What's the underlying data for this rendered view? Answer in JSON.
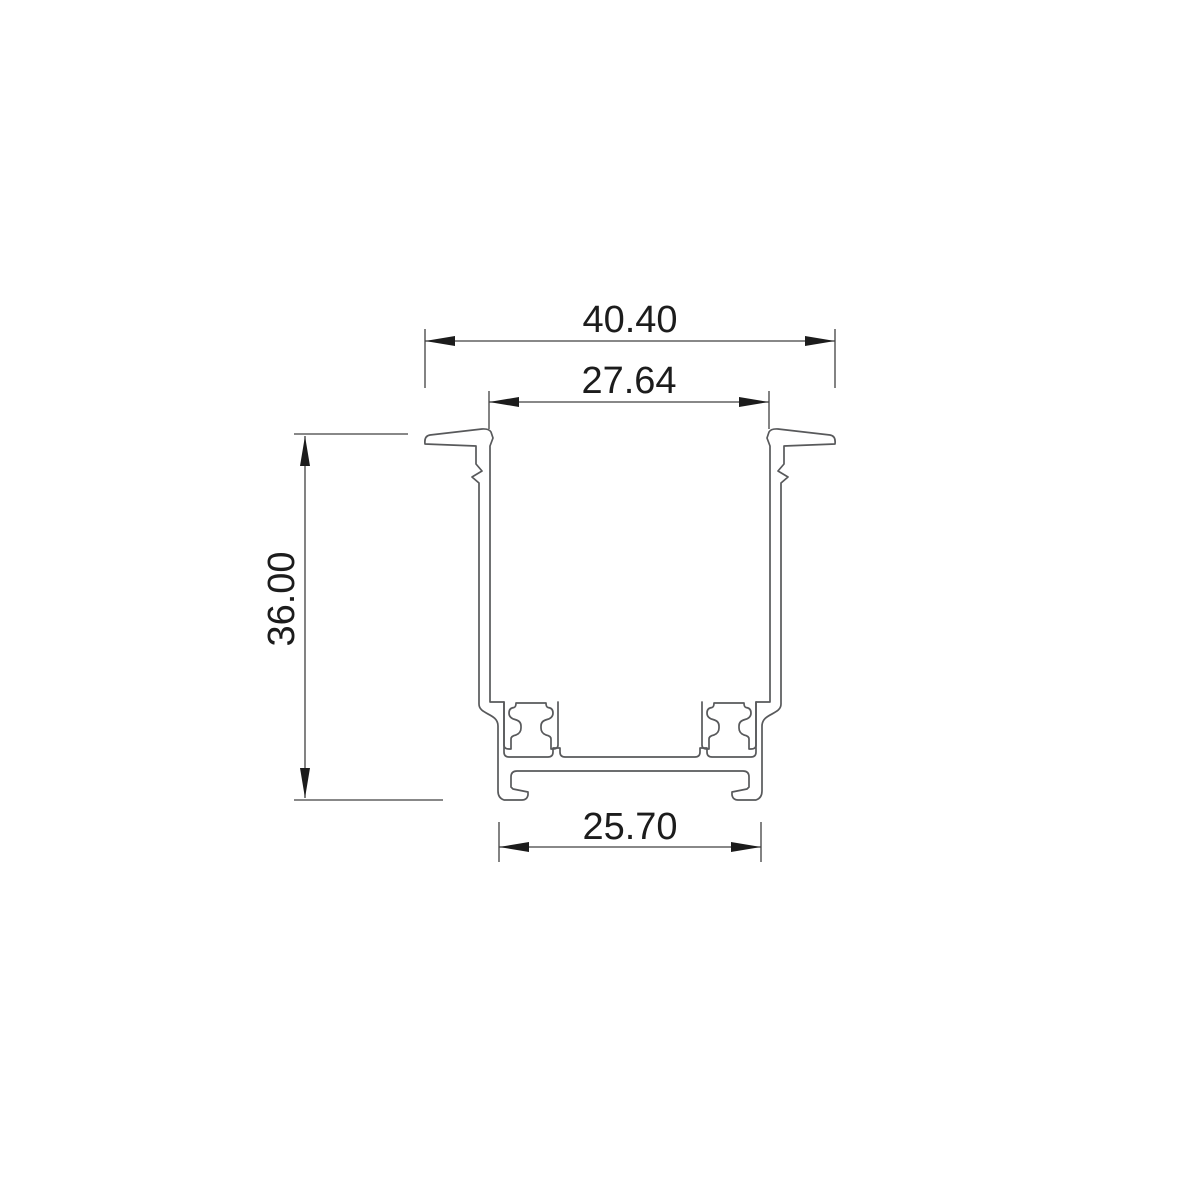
{
  "drawing": {
    "type": "profile-cross-section-dimension-drawing",
    "background": "#ffffff",
    "line_color": "#58595b",
    "dimension_line_color": "#404040",
    "text_color": "#1c1c1c",
    "dimensions": {
      "overall_width": {
        "label": "40.40",
        "orientation": "horizontal",
        "position": "top-outer"
      },
      "opening_width": {
        "label": "27.64",
        "orientation": "horizontal",
        "position": "top-inner"
      },
      "overall_height": {
        "label": "36.00",
        "orientation": "vertical",
        "position": "left"
      },
      "base_width": {
        "label": "25.70",
        "orientation": "horizontal",
        "position": "bottom"
      }
    }
  }
}
